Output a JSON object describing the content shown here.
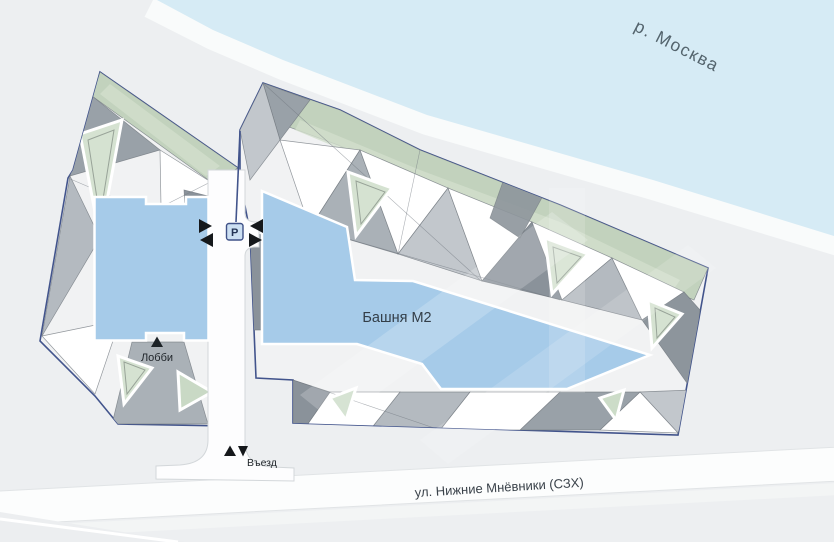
{
  "map": {
    "river_label": "р. Москва",
    "street_label": "ул. Нижние Мнёвники (СЗХ)",
    "tower_label": "Башня М2",
    "lobby_label": "Лобби",
    "entrance_label": "Въезд",
    "parking_label": "P",
    "colors": {
      "background": "#edeff1",
      "river_fill": "#d6ebf5",
      "parcel_outline": "#42548c",
      "building_fill": "#a6cbe9",
      "greenery": "#c2d2bd",
      "road_fill": "#fdfdfe"
    }
  }
}
